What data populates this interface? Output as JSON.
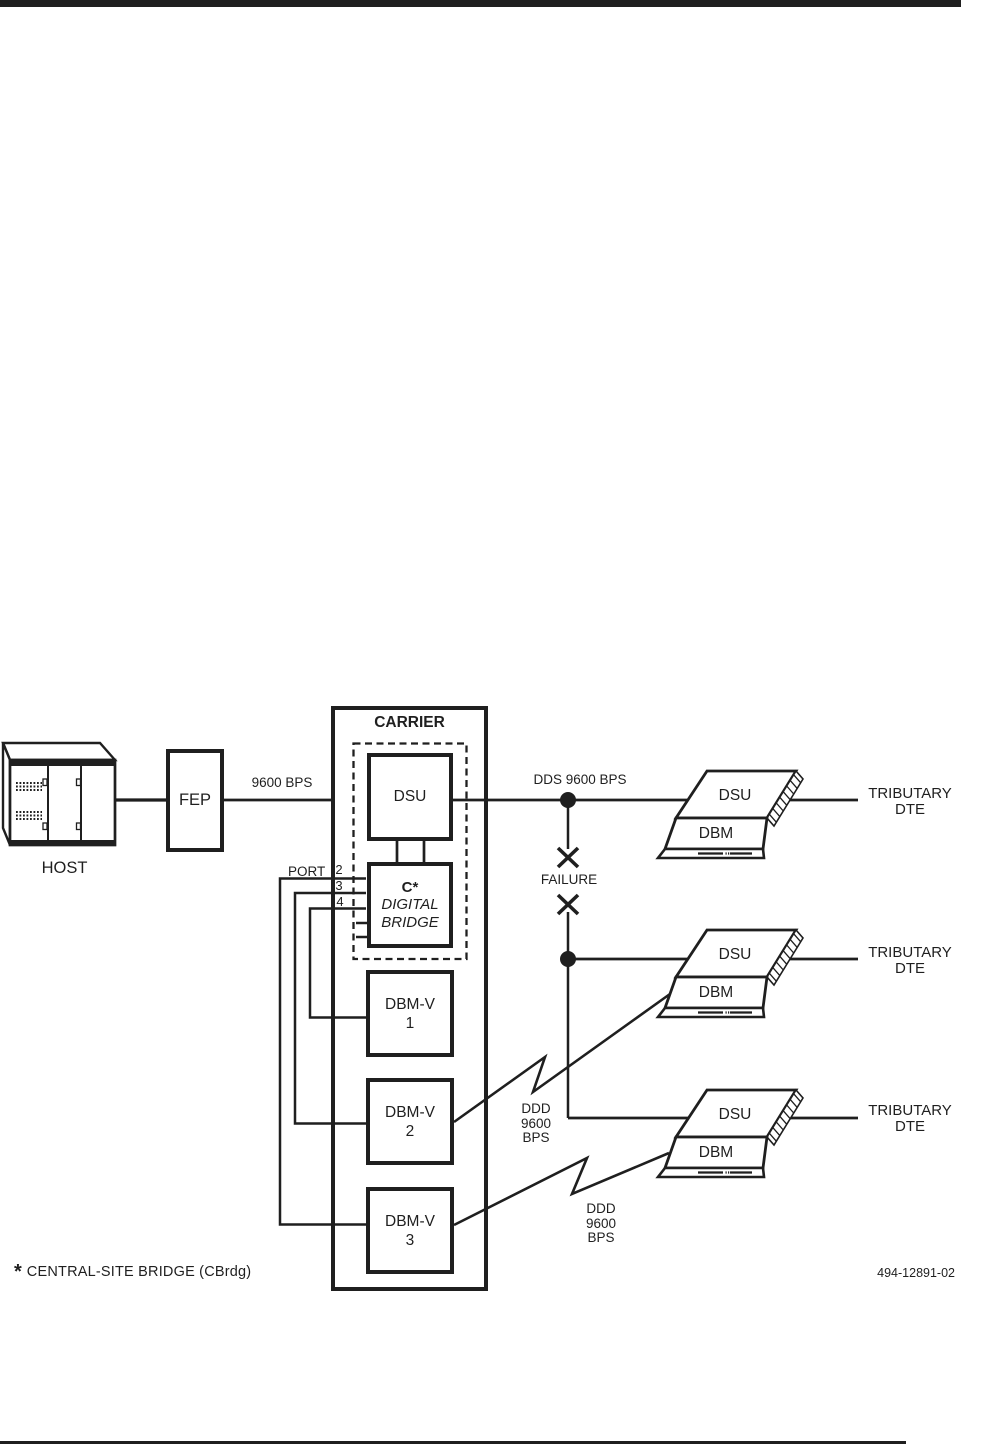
{
  "colors": {
    "ink": "#1f1f1f",
    "paper": "#ffffff"
  },
  "host": {
    "label": "HOST"
  },
  "fep": {
    "label": "FEP"
  },
  "link_labels": {
    "host_line": "9600 BPS",
    "dds_line": "DDS 9600 BPS",
    "failure": "FAILURE"
  },
  "carrier": {
    "title": "CARRIER",
    "dsu_label": "DSU",
    "bridge": {
      "name": "C*",
      "line2": "DIGITAL",
      "line3": "BRIDGE"
    },
    "port": {
      "label": "PORT",
      "numbers": [
        "2",
        "3",
        "4"
      ]
    },
    "dbmv": [
      {
        "label": "DBM-V",
        "number": "1"
      },
      {
        "label": "DBM-V",
        "number": "2"
      },
      {
        "label": "DBM-V",
        "number": "3"
      }
    ]
  },
  "ddd_labels": [
    {
      "line1": "DDD",
      "line2": "9600",
      "line3": "BPS"
    },
    {
      "line1": "DDD",
      "line2": "9600",
      "line3": "BPS"
    }
  ],
  "tributaries": [
    {
      "dsu": "DSU",
      "dbm": "DBM",
      "dte1": "TRIBUTARY",
      "dte2": "DTE"
    },
    {
      "dsu": "DSU",
      "dbm": "DBM",
      "dte1": "TRIBUTARY",
      "dte2": "DTE"
    },
    {
      "dsu": "DSU",
      "dbm": "DBM",
      "dte1": "TRIBUTARY",
      "dte2": "DTE"
    }
  ],
  "footnote": {
    "asterisk": "*",
    "text": "CENTRAL-SITE BRIDGE (CBrdg)"
  },
  "figure_number": "494-12891-02"
}
